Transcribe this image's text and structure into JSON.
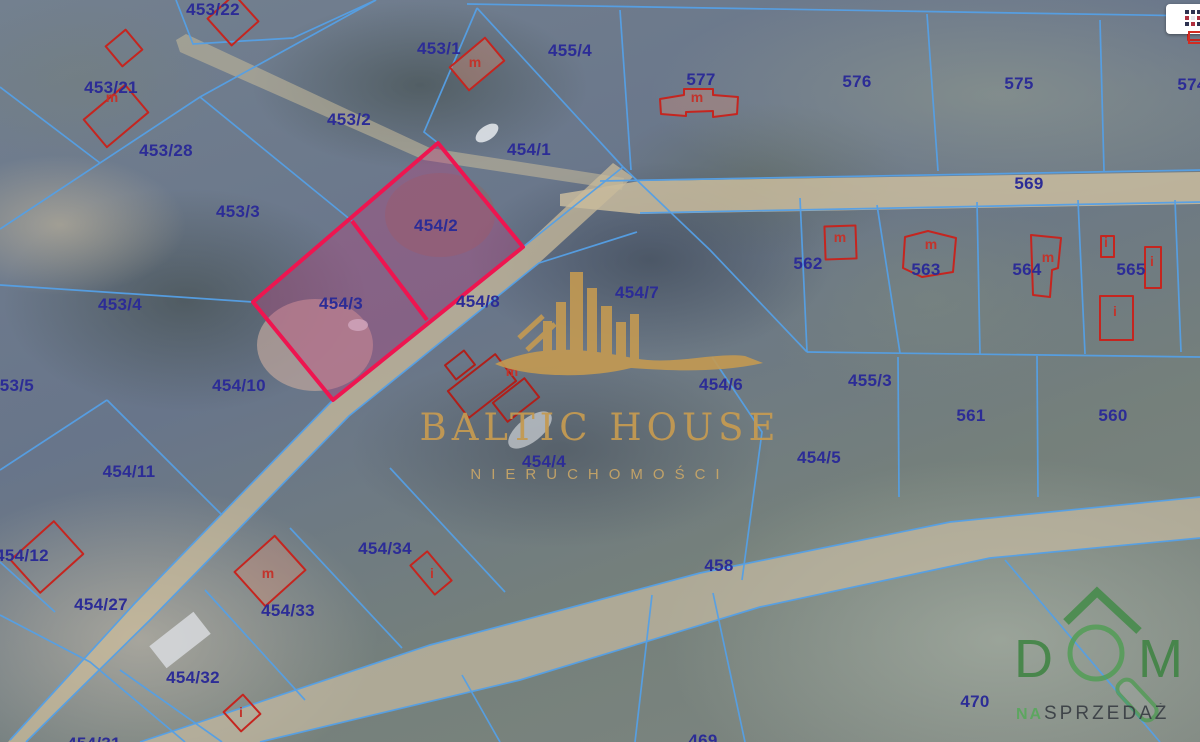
{
  "watermark": {
    "title": "BALTIC HOUSE",
    "subtitle": "NIERUCHOMOŚCI"
  },
  "logo": {
    "letter_d": "D",
    "letter_m": "M",
    "tagline_prefix": "NA",
    "tagline_main": "SPRZEDAŻ"
  },
  "toolbar": {
    "map_grid_button_icon": "grid-icon"
  },
  "map": {
    "highlighted_parcels": [
      "454/2",
      "454/3"
    ],
    "colors": {
      "parcel_line": "#55a0e6",
      "parcel_label": "#2c2c96",
      "building_outline": "#c5251f",
      "building_label": "#c2342c",
      "highlight_border": "#ee1550",
      "highlight_fill": "rgba(195,62,125,0.33)",
      "watermark_gold": "#c49a52",
      "logo_green": "#3f8a43",
      "tagline_text": "#3b4046",
      "road": "#cfc1a0"
    },
    "parcel_labels": [
      {
        "t": "453/22",
        "x": 213,
        "y": 10
      },
      {
        "t": "453/21",
        "x": 111,
        "y": 88
      },
      {
        "t": "453/2",
        "x": 349,
        "y": 120
      },
      {
        "t": "453/28",
        "x": 166,
        "y": 151
      },
      {
        "t": "453/1",
        "x": 439,
        "y": 49
      },
      {
        "t": "455/4",
        "x": 570,
        "y": 51
      },
      {
        "t": "577",
        "x": 701,
        "y": 80
      },
      {
        "t": "454/1",
        "x": 529,
        "y": 150
      },
      {
        "t": "576",
        "x": 857,
        "y": 82
      },
      {
        "t": "575",
        "x": 1019,
        "y": 84
      },
      {
        "t": "574",
        "x": 1192,
        "y": 85
      },
      {
        "t": "569",
        "x": 1029,
        "y": 184
      },
      {
        "t": "453/3",
        "x": 238,
        "y": 212
      },
      {
        "t": "454/2",
        "x": 436,
        "y": 226
      },
      {
        "t": "562",
        "x": 808,
        "y": 264
      },
      {
        "t": "563",
        "x": 926,
        "y": 270
      },
      {
        "t": "564",
        "x": 1027,
        "y": 270
      },
      {
        "t": "565",
        "x": 1131,
        "y": 270
      },
      {
        "t": "453/4",
        "x": 120,
        "y": 305
      },
      {
        "t": "454/3",
        "x": 341,
        "y": 304
      },
      {
        "t": "454/8",
        "x": 478,
        "y": 302
      },
      {
        "t": "454/7",
        "x": 637,
        "y": 293
      },
      {
        "t": "455/3",
        "x": 870,
        "y": 381
      },
      {
        "t": "453/5",
        "x": 12,
        "y": 386
      },
      {
        "t": "454/10",
        "x": 239,
        "y": 386
      },
      {
        "t": "454/6",
        "x": 721,
        "y": 385
      },
      {
        "t": "561",
        "x": 971,
        "y": 416
      },
      {
        "t": "560",
        "x": 1113,
        "y": 416
      },
      {
        "t": "454/11",
        "x": 129,
        "y": 472
      },
      {
        "t": "454/5",
        "x": 819,
        "y": 458
      },
      {
        "t": "454/4",
        "x": 544,
        "y": 462
      },
      {
        "t": "454/12",
        "x": 22,
        "y": 556
      },
      {
        "t": "454/34",
        "x": 385,
        "y": 549
      },
      {
        "t": "458",
        "x": 719,
        "y": 566
      },
      {
        "t": "454/27",
        "x": 101,
        "y": 605
      },
      {
        "t": "454/33",
        "x": 288,
        "y": 611
      },
      {
        "t": "454/32",
        "x": 193,
        "y": 678
      },
      {
        "t": "470",
        "x": 975,
        "y": 702
      },
      {
        "t": "454/31",
        "x": 94,
        "y": 744
      },
      {
        "t": "469",
        "x": 703,
        "y": 741
      }
    ],
    "building_labels": [
      {
        "t": "m",
        "x": 112,
        "y": 97
      },
      {
        "t": "m",
        "x": 475,
        "y": 62
      },
      {
        "t": "m",
        "x": 697,
        "y": 97
      },
      {
        "t": "m",
        "x": 840,
        "y": 237
      },
      {
        "t": "m",
        "x": 931,
        "y": 244
      },
      {
        "t": "m",
        "x": 1048,
        "y": 257
      },
      {
        "t": "i",
        "x": 1106,
        "y": 242
      },
      {
        "t": "i",
        "x": 1152,
        "y": 261
      },
      {
        "t": "i",
        "x": 1115,
        "y": 311
      },
      {
        "t": "m",
        "x": 512,
        "y": 371
      },
      {
        "t": "m",
        "x": 268,
        "y": 573
      },
      {
        "t": "i",
        "x": 432,
        "y": 573
      },
      {
        "t": "i",
        "x": 241,
        "y": 712
      }
    ]
  }
}
